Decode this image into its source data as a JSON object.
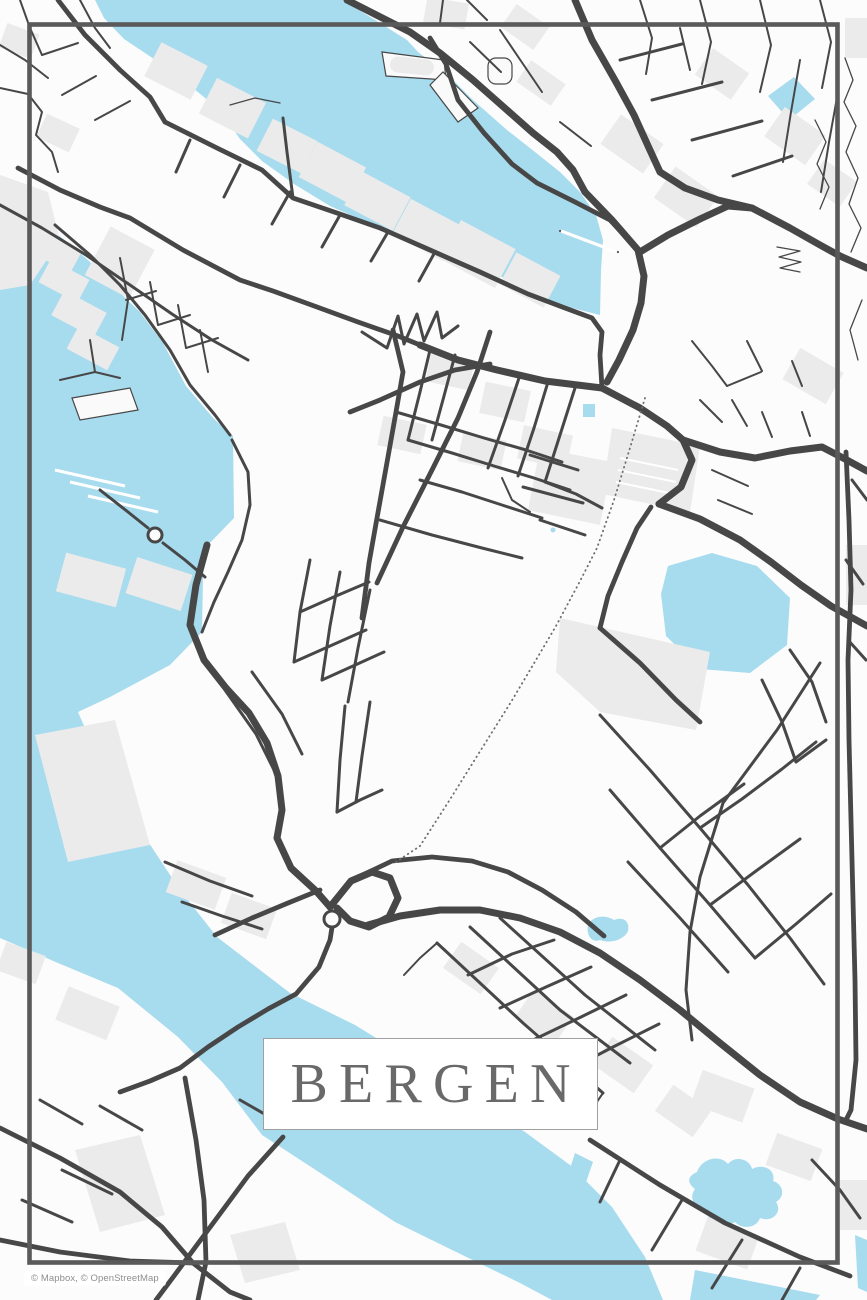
{
  "poster": {
    "title": "BERGEN"
  },
  "attribution": {
    "text": "© Mapbox, © OpenStreetMap"
  },
  "colors": {
    "water": "#a7dbee",
    "land": "#fcfcfc",
    "blocks": "#ebebeb",
    "road": "#474747",
    "frame": "#5a5a5a",
    "title-text": "#696969",
    "title-border": "#a0a0a0",
    "attribution-text": "#8e8e8e"
  }
}
